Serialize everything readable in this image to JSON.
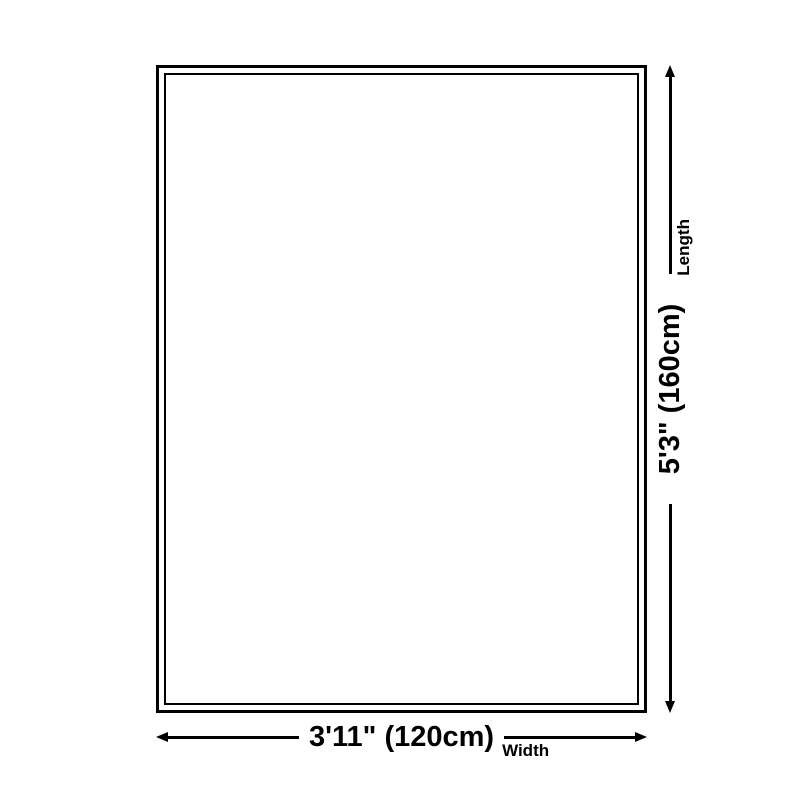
{
  "diagram": {
    "colors": {
      "line": "#000000",
      "background": "#ffffff"
    },
    "width_dimension": {
      "value": "3'11\" (120cm)",
      "label": "Width"
    },
    "length_dimension": {
      "value": "5'3\" (160cm)",
      "label": "Length"
    }
  }
}
